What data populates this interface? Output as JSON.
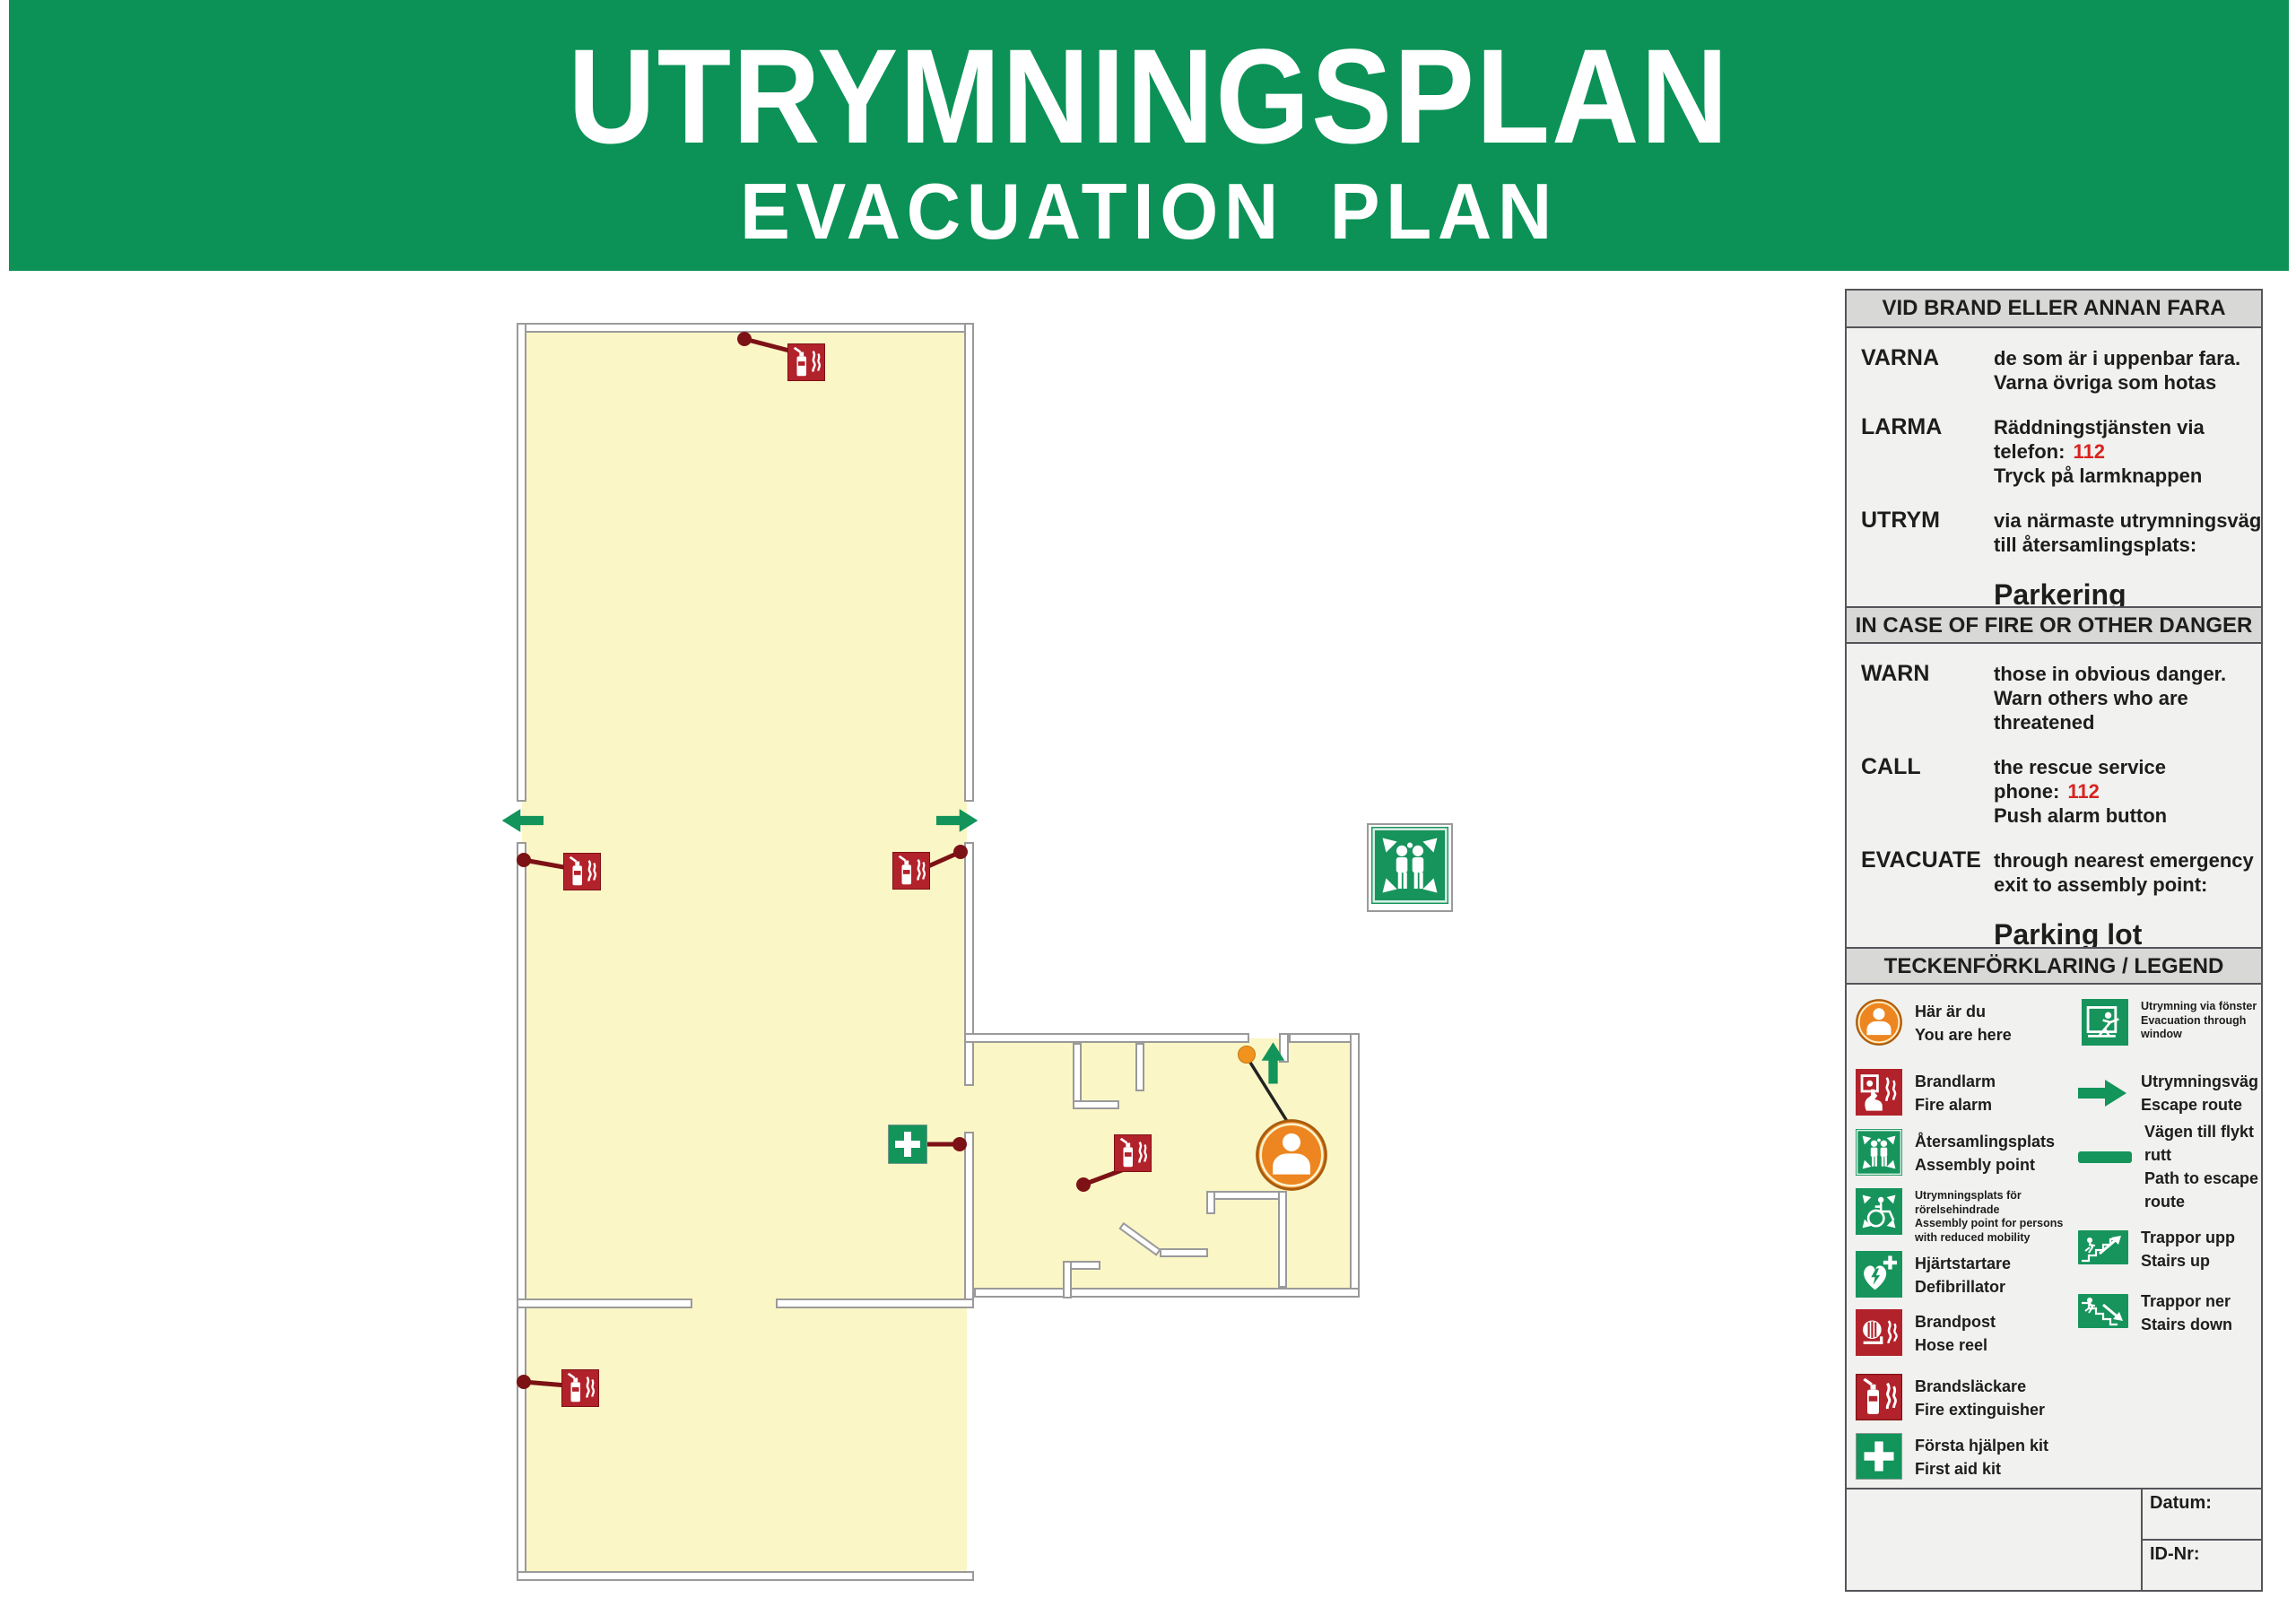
{
  "header": {
    "title": "UTRYMNINGSPLAN",
    "subtitle": "EVACUATION PLAN"
  },
  "sv": {
    "header": "VID BRAND ELLER ANNAN FARA",
    "warn_label": "VARNA",
    "warn_line1": "de som är i uppenbar fara.",
    "warn_line2": "Varna övriga som hotas",
    "call_label": "LARMA",
    "call_line1": "Räddningstjänsten via",
    "call_phone_prefix": "telefon:",
    "call_phone": "112",
    "call_line2": "Tryck på larmknappen",
    "evac_label": "UTRYM",
    "evac_line1": "via närmaste utrymningsväg",
    "evac_line2": "till återsamlingsplats:",
    "assembly_point": "Parkering"
  },
  "en": {
    "header": "IN CASE OF FIRE OR OTHER DANGER",
    "warn_label": "WARN",
    "warn_line1": "those in obvious danger.",
    "warn_line2": "Warn others who are",
    "warn_line3": "threatened",
    "call_label": "CALL",
    "call_line1": "the rescue service",
    "call_phone_prefix": "phone:",
    "call_phone": "112",
    "call_line2": "Push alarm button",
    "evac_label": "EVACUATE",
    "evac_line1": "through nearest emergency",
    "evac_line2": "exit to assembly point:",
    "assembly_point": "Parking lot"
  },
  "legend": {
    "header": "TECKENFÖRKLARING / LEGEND",
    "you_are_here": {
      "sv": "Här är du",
      "en": "You are here"
    },
    "fire_alarm": {
      "sv": "Brandlarm",
      "en": "Fire alarm"
    },
    "assembly": {
      "sv": "Återsamlingsplats",
      "en": "Assembly point"
    },
    "assembly_reduced": {
      "sv": "Utrymningsplats för rörelsehindrade",
      "en": "Assembly point for persons with reduced mobility"
    },
    "defibrillator": {
      "sv": "Hjärtstartare",
      "en": "Defibrillator"
    },
    "hose_reel": {
      "sv": "Brandpost",
      "en": "Hose reel"
    },
    "extinguisher": {
      "sv": "Brandsläckare",
      "en": "Fire extinguisher"
    },
    "first_aid": {
      "sv": "Första hjälpen kit",
      "en": "First aid kit"
    },
    "window_escape": {
      "sv": "Utrymning via fönster",
      "en": "Evacuation through window"
    },
    "escape_route": {
      "sv": "Utrymningsväg",
      "en": "Escape route"
    },
    "escape_path": {
      "sv": "Vägen till flykt rutt",
      "en": "Path to escape route"
    },
    "stairs_up": {
      "sv": "Trappor upp",
      "en": "Stairs up"
    },
    "stairs_down": {
      "sv": "Trappor ner",
      "en": "Stairs down"
    }
  },
  "footer": {
    "date_label": "Datum:",
    "id_label": "ID-Nr:"
  },
  "colors": {
    "brand_green": "#0c9257",
    "sign_green": "#16945c",
    "sign_red": "#b2222b",
    "leader_red": "#7c1215",
    "alarm_red": "#d8231f",
    "floor_yellow": "#fbf6c5",
    "yah_orange": "#ed8620",
    "wall_gray": "#9a9a9a",
    "panel_border": "#54555a",
    "band_gray": "#d8d8d6",
    "panel_bg": "#f1f1ef"
  }
}
